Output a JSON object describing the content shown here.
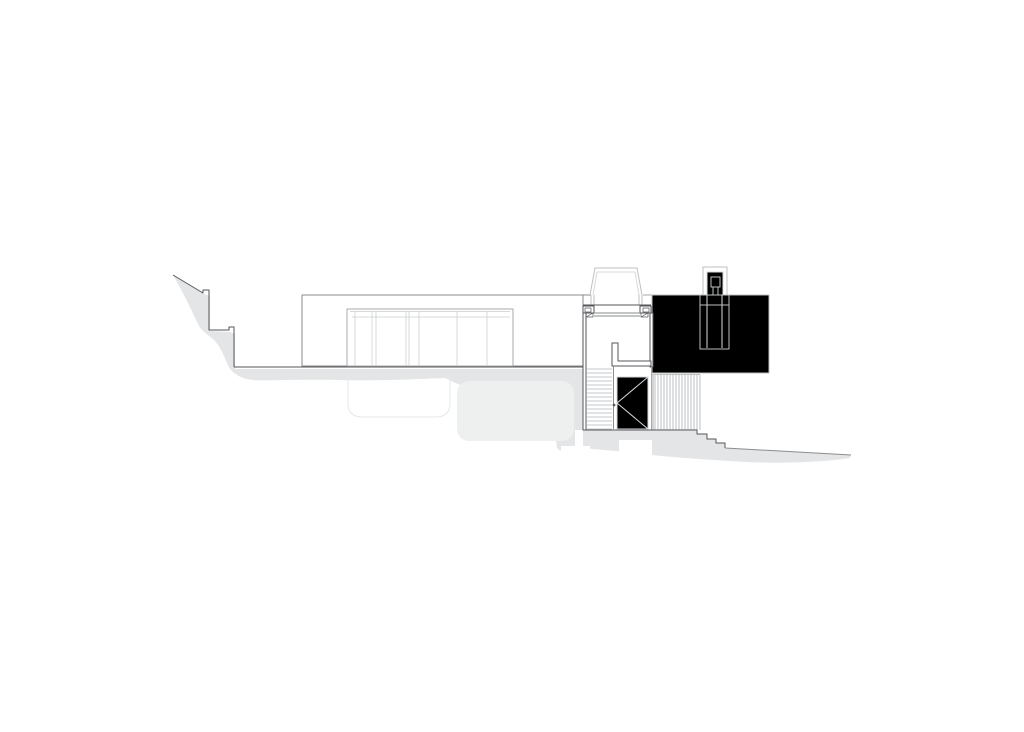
{
  "canvas": {
    "width": 1024,
    "height": 732,
    "background": "#ffffff"
  },
  "palette": {
    "ink": "#55565a",
    "med": "#8a8c8e",
    "soft": "#a7a9ab",
    "light": "#bdbfc1",
    "midlight": "#c6c7c9",
    "xlight": "#d7d8da",
    "faint": "#e6e7e8",
    "shade": "#e4e5e6",
    "shade2": "#eeefef",
    "white": "#ffffff"
  },
  "drawing": {
    "elements": [
      {
        "name": "terrain-shade-left-band",
        "type": "path",
        "fill": "shade",
        "d": "M173,275 L204,294 L210,296 L210,331 L230,332 L235,334 L235,369 L584,369 L584,452 C574,456 563,454 557,448 L556,440 C554,430 552,420 548,412 C530,400 500,392 470,388 C460,386 452,381 445,378 C420,379 380,381 340,380 C300,379 262,381 253,380 C242,379 231,374 227,363 C223,353 219,345 214,340 C207,334 201,331 197,322 C192,311 184,294 173,275 Z"
      },
      {
        "name": "terrain-shade-right-band",
        "type": "path",
        "fill": "shade",
        "d": "M584,430 L697,430 L697,434 L707,434 L707,439 L716,439 L716,443 L725,443 L725,448 L851,455 L850,458 C818,463 768,464 729,461 C699,459 668,457 644,454 C620,451 600,450 584,448 Z"
      },
      {
        "name": "buried-volume-right-fill",
        "type": "rect",
        "x": 457,
        "y": 381,
        "w": 117,
        "h": 60,
        "rx": 12,
        "fill": "shade2"
      },
      {
        "name": "footing-wall-white-cut",
        "type": "rect",
        "x": 575,
        "y": 430,
        "w": 8,
        "h": 17,
        "fill": "white"
      },
      {
        "name": "footing-pad-white-cut",
        "type": "rect",
        "x": 561,
        "y": 446,
        "w": 29,
        "h": 9,
        "fill": "white"
      },
      {
        "name": "footing-white-cut-under-door",
        "type": "rect",
        "x": 619,
        "y": 440,
        "w": 33,
        "h": 17,
        "fill": "white"
      },
      {
        "name": "buried-tank-outline",
        "type": "path",
        "stroke": "faint",
        "d": "M348,371 L348,403 Q348,417 362,417 L436,417 Q450,417 450,403 L450,373"
      },
      {
        "name": "main-building-outline",
        "type": "rect",
        "x": 302,
        "y": 295,
        "w": 281,
        "h": 71,
        "stroke": "med",
        "fill": "white"
      },
      {
        "name": "roof-line-left-extension",
        "type": "line",
        "x1": 583,
        "y1": 295,
        "x2": 591,
        "y2": 295,
        "stroke": "med"
      },
      {
        "name": "roof-line-right",
        "type": "line",
        "x1": 643,
        "y1": 295,
        "x2": 769,
        "y2": 295,
        "stroke": "soft"
      },
      {
        "name": "rear-wing-outline",
        "type": "rect",
        "x": 652,
        "y": 295,
        "w": 117,
        "h": 78,
        "stroke": "light",
        "fill": "none"
      },
      {
        "name": "chimney-outline",
        "type": "rect",
        "x": 703,
        "y": 267,
        "w": 24,
        "h": 28,
        "stroke": "light",
        "fill": "white"
      },
      {
        "name": "chimney-inner-outline",
        "type": "rect",
        "x": 707,
        "y": 272,
        "w": 16,
        "h": 23,
        "stroke": "xlight",
        "fill": "none"
      },
      {
        "name": "chimney-cap",
        "type": "rect",
        "x": 711,
        "y": 277,
        "w": 9,
        "h": 10,
        "stroke": "light",
        "fill": "none"
      },
      {
        "name": "chimney-flue-line-a",
        "type": "line",
        "x1": 713,
        "y1": 287,
        "x2": 713,
        "y2": 297,
        "stroke": "light"
      },
      {
        "name": "chimney-flue-line-b",
        "type": "line",
        "x1": 718,
        "y1": 287,
        "x2": 718,
        "y2": 297,
        "stroke": "light"
      },
      {
        "name": "fireplace-column",
        "type": "rect",
        "x": 700,
        "y": 295,
        "w": 29,
        "h": 54,
        "stroke": "light",
        "fill": "none"
      },
      {
        "name": "fireplace-column-inner-a",
        "type": "line",
        "x1": 707,
        "y1": 295,
        "x2": 707,
        "y2": 348,
        "stroke": "xlight"
      },
      {
        "name": "fireplace-column-inner-b",
        "type": "line",
        "x1": 722,
        "y1": 295,
        "x2": 722,
        "y2": 348,
        "stroke": "xlight"
      },
      {
        "name": "fireplace-mantle-line",
        "type": "line",
        "x1": 700,
        "y1": 305,
        "x2": 729,
        "y2": 305,
        "stroke": "light"
      },
      {
        "name": "window-frame",
        "type": "rect",
        "x": 347,
        "y": 309,
        "w": 166,
        "h": 57,
        "stroke": "soft",
        "fill": "white"
      },
      {
        "name": "window-head-line",
        "type": "line",
        "x1": 350,
        "y1": 311.5,
        "x2": 510,
        "y2": 311.5,
        "stroke": "xlight"
      },
      {
        "name": "window-transom-line",
        "type": "line",
        "x1": 352,
        "y1": 317,
        "x2": 510,
        "y2": 317,
        "stroke": "xlight"
      },
      {
        "name": "window-mullions",
        "type": "vlines",
        "xs": [
          355,
          372,
          376,
          406,
          409,
          419,
          457,
          487
        ],
        "y1": 311,
        "y2": 365,
        "stroke": "xlight"
      },
      {
        "name": "skylight-outer-profile",
        "type": "polyline",
        "points": "590,295 595,268 637,268 642,295",
        "stroke": "light"
      },
      {
        "name": "skylight-inner-profile",
        "type": "polyline",
        "points": "593,295 597,272 635,272 639,295",
        "stroke": "xlight"
      },
      {
        "name": "skylight-curb-lines",
        "type": "vlines",
        "xs": [
          591,
          594,
          639,
          642
        ],
        "y1": 295,
        "y2": 305,
        "stroke": "light"
      },
      {
        "name": "stair-lintel-beam",
        "type": "line",
        "x1": 583,
        "y1": 305,
        "x2": 651,
        "y2": 305,
        "stroke": "ink"
      },
      {
        "name": "lintel-block-left",
        "type": "rect",
        "x": 583,
        "y": 306,
        "w": 11,
        "h": 7,
        "stroke": "ink",
        "fill": "white"
      },
      {
        "name": "lintel-block-right",
        "type": "rect",
        "x": 640,
        "y": 306,
        "w": 11,
        "h": 7,
        "stroke": "ink",
        "fill": "white"
      },
      {
        "name": "lintel-block-left-inner",
        "type": "rect",
        "x": 585,
        "y": 308,
        "w": 6,
        "h": 4,
        "stroke": "ink",
        "w2": 0.7
      },
      {
        "name": "lintel-block-right-inner",
        "type": "rect",
        "x": 643,
        "y": 308,
        "w": 6,
        "h": 4,
        "stroke": "ink",
        "w2": 0.7
      },
      {
        "name": "post-cut-left",
        "type": "rect",
        "x": 586,
        "y": 313,
        "w": 7,
        "h": 4,
        "stroke": "ink",
        "w2": 0.7
      },
      {
        "name": "post-cut-left-hatch",
        "type": "line",
        "x1": 586,
        "y1": 317,
        "x2": 593,
        "y2": 313,
        "stroke": "ink",
        "w2": 0.7
      },
      {
        "name": "post-cut-right",
        "type": "rect",
        "x": 641,
        "y": 313,
        "w": 7,
        "h": 4,
        "stroke": "ink",
        "w2": 0.7
      },
      {
        "name": "post-cut-right-hatch",
        "type": "line",
        "x1": 641,
        "y1": 317,
        "x2": 648,
        "y2": 313,
        "stroke": "ink",
        "w2": 0.7
      },
      {
        "name": "glazing-head-line-a",
        "type": "line",
        "x1": 594,
        "y1": 313,
        "x2": 640,
        "y2": 313,
        "stroke": "med"
      },
      {
        "name": "glazing-head-line-b",
        "type": "line",
        "x1": 594,
        "y1": 316,
        "x2": 640,
        "y2": 316,
        "stroke": "med"
      },
      {
        "name": "stair-tower-left-wall",
        "type": "rect",
        "x": 583,
        "y": 313,
        "w": 3,
        "h": 117,
        "stroke": "ink",
        "fill": "white"
      },
      {
        "name": "stair-tower-right-wall",
        "type": "rect",
        "x": 650,
        "y": 313,
        "w": 3,
        "h": 54,
        "stroke": "ink",
        "fill": "white"
      },
      {
        "name": "stair-tower-right-wall-lower",
        "type": "line",
        "x1": 651.5,
        "y1": 367,
        "x2": 651.5,
        "y2": 430,
        "stroke": "soft"
      },
      {
        "name": "stair-landing-guard",
        "type": "path",
        "stroke": "ink",
        "fill": "white",
        "d": "M612,343 L612,366 L651,366 L651,361 L618,361 L618,343 Z"
      },
      {
        "name": "stair-treads",
        "type": "hlines",
        "y_from": 369,
        "y_to": 429,
        "step": 4,
        "x1": 587,
        "x2": 612,
        "stroke": "midlight"
      },
      {
        "name": "stair-door-edge",
        "type": "line",
        "x1": 613.5,
        "y1": 366,
        "x2": 613.5,
        "y2": 429,
        "stroke": "med"
      },
      {
        "name": "stair-door-handle",
        "type": "circle",
        "cx": 614,
        "cy": 405,
        "r": 1.4,
        "fill": "ink"
      },
      {
        "name": "stair-door-panel",
        "type": "rect",
        "x": 617,
        "y": 377,
        "w": 31,
        "h": 52,
        "stroke": "xlight",
        "fill": "none"
      },
      {
        "name": "door-swing-line-a",
        "type": "line",
        "x1": 648,
        "y1": 377,
        "x2": 617,
        "y2": 403,
        "stroke": "xlight"
      },
      {
        "name": "door-swing-line-b",
        "type": "line",
        "x1": 617,
        "y1": 403,
        "x2": 648,
        "y2": 429,
        "stroke": "xlight"
      },
      {
        "name": "retaining-wall-hatch",
        "type": "vlines",
        "x_from": 655,
        "x_to": 699,
        "step": 3,
        "y1": 375,
        "y2": 430,
        "stroke": "light"
      },
      {
        "name": "retaining-wall-left-edge",
        "type": "line",
        "x1": 653,
        "y1": 375,
        "x2": 653,
        "y2": 430,
        "stroke": "soft"
      },
      {
        "name": "retaining-wall-top-edge",
        "type": "line",
        "x1": 652,
        "y1": 374.5,
        "x2": 700,
        "y2": 374.5,
        "stroke": "light"
      },
      {
        "name": "retaining-wall-right-edge",
        "type": "line",
        "x1": 700,
        "y1": 375,
        "x2": 700,
        "y2": 430,
        "stroke": "light"
      },
      {
        "name": "terrain-profile-left",
        "type": "path",
        "stroke": "ink",
        "d": "M173,275 L203,293 L203,290 L209,290 L209,330 L229,330 L229,327 L234,327 L234,367"
      },
      {
        "name": "terrain-ground-line",
        "type": "line",
        "x1": 234,
        "y1": 367,
        "x2": 583,
        "y2": 367,
        "stroke": "ink"
      },
      {
        "name": "terrain-steps-right",
        "type": "path",
        "stroke": "ink",
        "d": "M586,430 L697,430 L697,434 L707,434 L707,439 L716,439 L716,443 L725,443 L725,448"
      },
      {
        "name": "terrain-slope-right",
        "type": "line",
        "x1": 725,
        "y1": 448,
        "x2": 851,
        "y2": 455,
        "stroke": "med"
      }
    ]
  }
}
